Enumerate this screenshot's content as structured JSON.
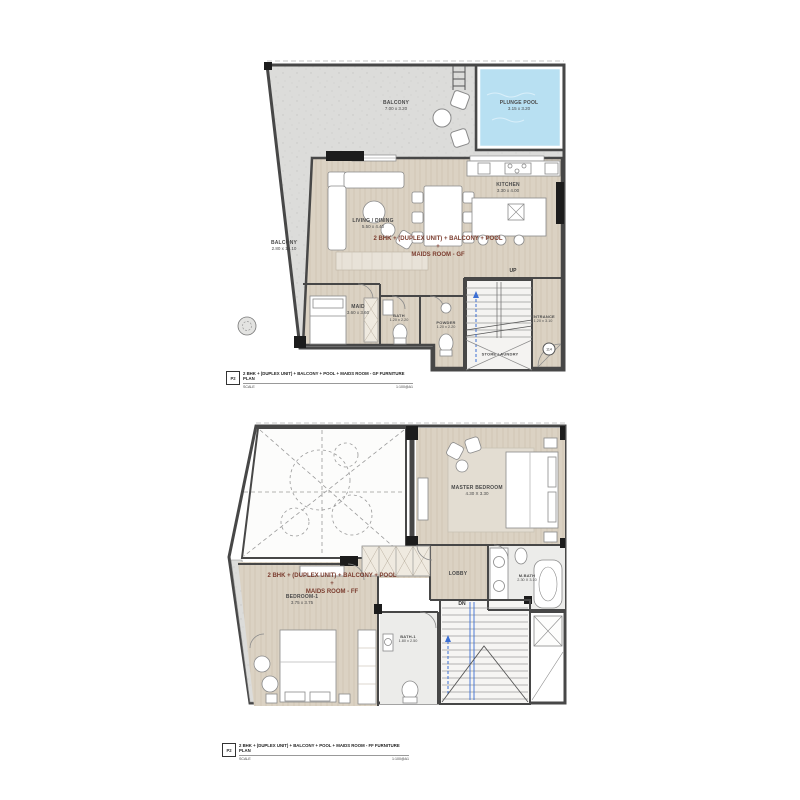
{
  "colors": {
    "wall": "#474747",
    "wood_floor": "#dbd2c3",
    "balcony_floor": "#dcdcda",
    "pool_water": "#b8e0f2",
    "tile_floor": "#ececea",
    "unit_title_text": "#7b3c2e",
    "stair_guide_blue": "#3b6fd4"
  },
  "gf": {
    "balcony_top": {
      "name": "BALCONY",
      "dims": "7.00 x 3.20"
    },
    "plunge_pool": {
      "name": "PLUNGE POOL",
      "dims": "3.15 x 3.20"
    },
    "balcony_left": {
      "name": "BALCONY",
      "dims": "2.80 x 10.10"
    },
    "living_dining": {
      "name": "LIVING / DINING",
      "dims": "5.50 x 4.40"
    },
    "kitchen": {
      "name": "KITCHEN",
      "dims": "3.30 x 4.00"
    },
    "maid": {
      "name": "MAID",
      "dims": "3.60 x 3.60"
    },
    "bath": {
      "name": "BATH",
      "dims": "1.20 x 2.20"
    },
    "powder": {
      "name": "POWDER",
      "dims": "1.20 x 2.20"
    },
    "entrance": {
      "name": "ENTRANCE",
      "dims": "1.20 x 3.10"
    },
    "store_laundry": "STORE LAUNDRY",
    "stair_direction": "UP",
    "door_tag": "114",
    "unit_title_line1": "2 BHK + (DUPLEX UNIT) + BALCONY + POOL +",
    "unit_title_line2": "MAIDS ROOM - GF",
    "footer": {
      "sheet": "P2",
      "title": "2 BHK + (DUPLEX UNIT) + BALCONY + POOL + MAIDS ROOM - GF  FURNITURE PLAN",
      "scale_label": "SCALE",
      "scale_value": "1:100@A1"
    }
  },
  "ff": {
    "master_bedroom": {
      "name": "MASTER BEDROOM",
      "dims": "4.30 X 3.30"
    },
    "bedroom1": {
      "name": "BEDROOM-1",
      "dims": "3.75 x 3.75"
    },
    "lobby": {
      "name": "LOBBY"
    },
    "mbath": {
      "name": "M.BATH",
      "dims": "2.30 X 3.10"
    },
    "bath1": {
      "name": "BATH-1",
      "dims": "1.80 x 2.50"
    },
    "stair_direction": "DN",
    "unit_title_line1": "2 BHK + (DUPLEX UNIT) + BALCONY + POOL +",
    "unit_title_line2": "MAIDS ROOM - FF",
    "footer": {
      "sheet": "P2",
      "title": "2 BHK + (DUPLEX UNIT) + BALCONY + POOL + MAIDS ROOM - FF  FURNITURE PLAN",
      "scale_label": "SCALE",
      "scale_value": "1:100@A1"
    }
  }
}
